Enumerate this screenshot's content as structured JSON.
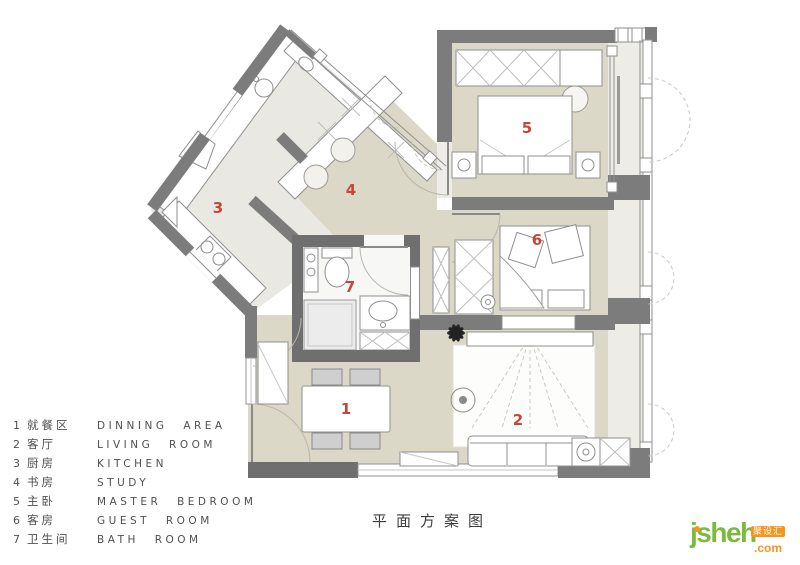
{
  "title": "平面方案图",
  "plan": {
    "room_numbers": [
      "1",
      "2",
      "3",
      "4",
      "5",
      "6",
      "7"
    ],
    "fridge_label": "冰箱"
  },
  "legend": {
    "items": [
      {
        "num": "1",
        "zh": "就餐区",
        "en": "DINNING AREA"
      },
      {
        "num": "2",
        "zh": "客厅",
        "en": "LIVING ROOM"
      },
      {
        "num": "3",
        "zh": "厨房",
        "en": "KITCHEN"
      },
      {
        "num": "4",
        "zh": "书房",
        "en": "STUDY"
      },
      {
        "num": "5",
        "zh": "主卧",
        "en": "MASTER BEDROOM"
      },
      {
        "num": "6",
        "zh": "客房",
        "en": "GUEST ROOM"
      },
      {
        "num": "7",
        "zh": "卫生间",
        "en": "BATH ROOM"
      }
    ]
  },
  "brand": {
    "name": "jsheh",
    "tld": ".com",
    "badge": "聚设汇"
  },
  "colors": {
    "room_number": "#c6453a",
    "wall_gray": "#7c7c7c",
    "wall_dark": "#6f6f6f",
    "floor_beige": "#dbd8c8",
    "floor_light": "#e9e8e2",
    "brand_green": "#7cb93e",
    "brand_orange": "#f7941e"
  }
}
